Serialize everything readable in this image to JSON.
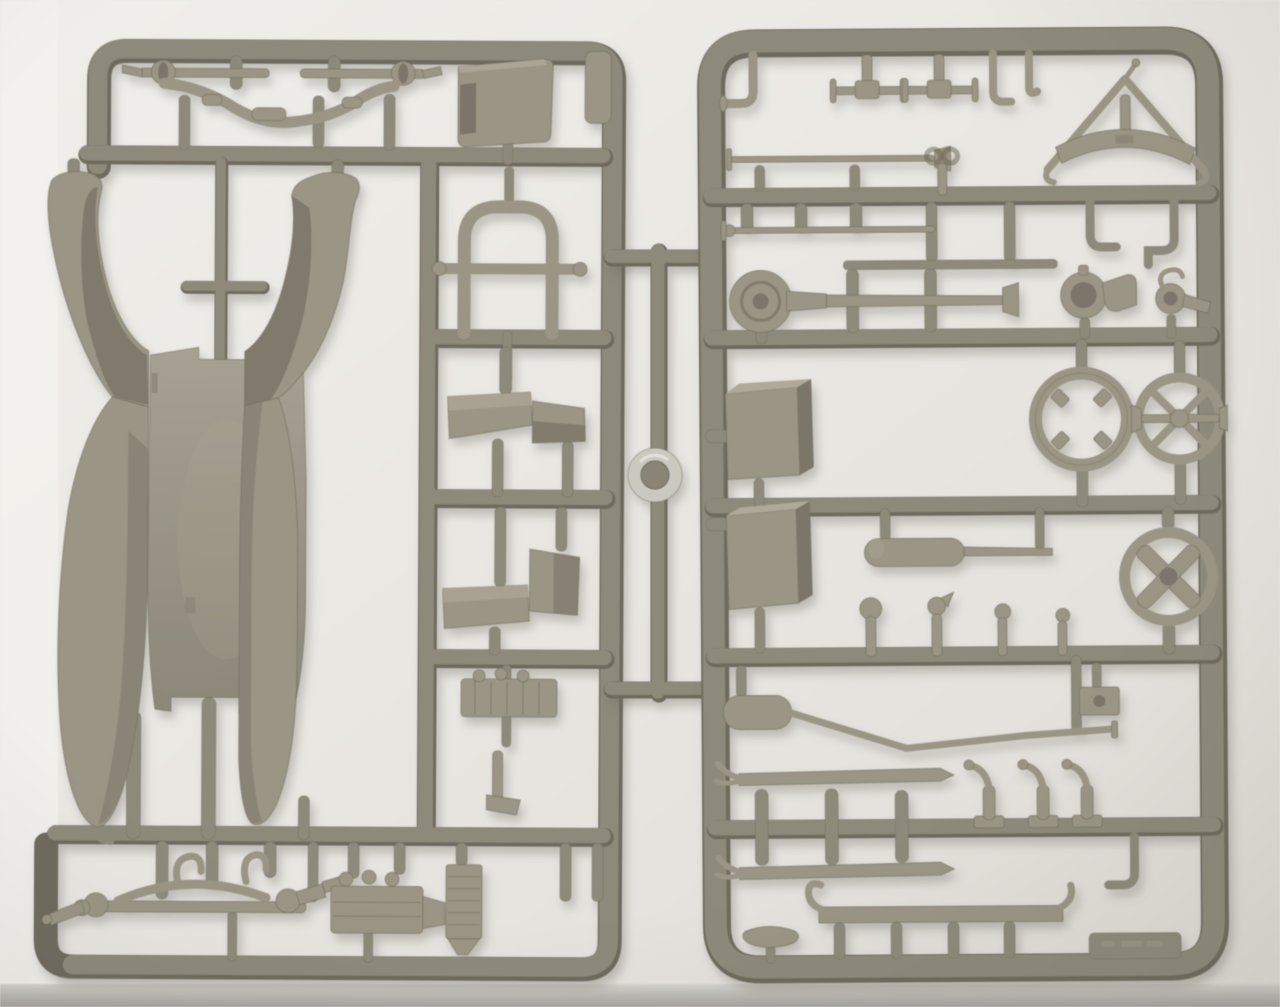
{
  "photo": {
    "subject": "injection-molded plastic model kit sprues, olive-grey styrene, photographed on white background",
    "palette": {
      "bg": "#ece9e4",
      "bgBright": "#f6f4f0",
      "bgShade": "#e0ddd6",
      "tableEdge": "#a7a49f",
      "runner": "#8f8a7a",
      "runnerDark": "#6e6a5c",
      "runnerLight": "#aba693",
      "part": "#9b9583",
      "partDark": "#7c7667",
      "partLight": "#b0aa98",
      "edge": "#67634f",
      "button": "#cdc9bf",
      "shadow": "#6a6558"
    },
    "left_sprue": {
      "name": "sprue-a-body-parts",
      "parts": [
        {
          "name": "front-axle-with-spindles-and-drop-beam"
        },
        {
          "name": "dash-panel-plate"
        },
        {
          "name": "embossed-molding-tab"
        },
        {
          "name": "seat-frame-arch"
        },
        {
          "name": "running-board-step-front"
        },
        {
          "name": "running-board-step-rear"
        },
        {
          "name": "ribbed-engine-head"
        },
        {
          "name": "small-bracket"
        },
        {
          "name": "one-piece-body-floor-with-four-fenders"
        },
        {
          "name": "rear-axle-with-leaf-spring"
        },
        {
          "name": "engine-block-with-radiator-core"
        }
      ]
    },
    "connector": {
      "name": "center-runner-with-sprue-button"
    },
    "right_sprue": {
      "name": "sprue-b-detail-parts",
      "parts": [
        {
          "name": "elbow-lever"
        },
        {
          "name": "pedal-cross-shaft-1"
        },
        {
          "name": "pedal-cross-shaft-2"
        },
        {
          "name": "hook-brackets"
        },
        {
          "name": "windshield-a-frame-with-bow"
        },
        {
          "name": "thin-rod-long-1"
        },
        {
          "name": "wing-key"
        },
        {
          "name": "thin-rod-long-2"
        },
        {
          "name": "runner-bar-segment"
        },
        {
          "name": "drag-link-with-disc-end"
        },
        {
          "name": "headlamp-with-bracket"
        },
        {
          "name": "small-lamp-horn"
        },
        {
          "name": "fuel-tank-box"
        },
        {
          "name": "storage-box"
        },
        {
          "name": "wheel-rim-with-clips"
        },
        {
          "name": "steering-wheel-x-spokes"
        },
        {
          "name": "hand-wheel-thick-cross"
        },
        {
          "name": "muffler-with-straight-pipe"
        },
        {
          "name": "muffler-with-bent-tailpipe"
        },
        {
          "name": "gear-levers"
        },
        {
          "name": "junction-box"
        },
        {
          "name": "leaf-spring-blade-1"
        },
        {
          "name": "leaf-spring-blade-2"
        },
        {
          "name": "crank-handles"
        },
        {
          "name": "corner-hook-bracket"
        },
        {
          "name": "seat-bench-rail-with-studs"
        },
        {
          "name": "saddle-seat"
        },
        {
          "name": "embossed-label-tab"
        }
      ]
    }
  }
}
